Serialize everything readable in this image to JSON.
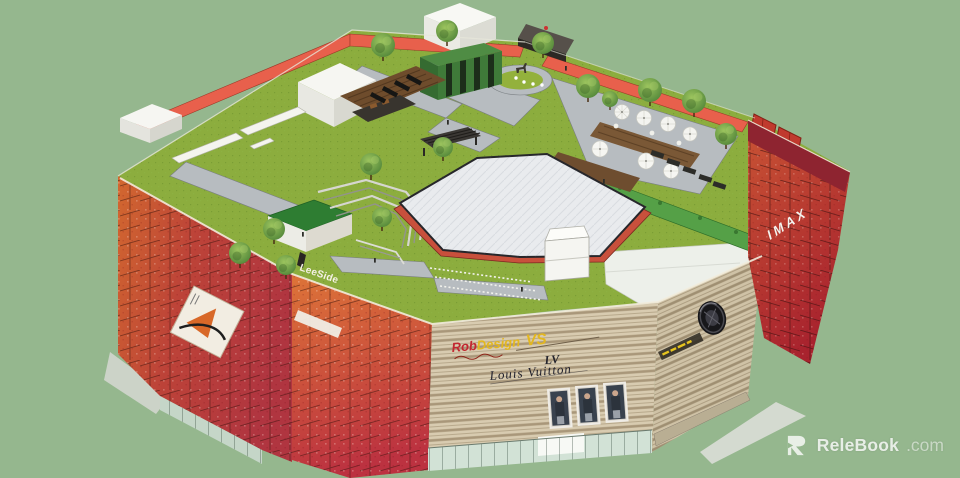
{
  "scene": {
    "type": "3d-architectural-render",
    "subject": "shopping mall rooftop garden with ice rink"
  },
  "signs": {
    "left_tower_sign": "LeeSide",
    "right_tower_sign": "IMAX",
    "front_brand": "Rob",
    "front_brand2": "Design",
    "front_brand_mark": "VS",
    "luxury_brand": "Louis Vuitton",
    "luxury_monogram": "LV"
  },
  "watermark": {
    "logo": "R",
    "brand": "ReleBook",
    "suffix": ".com"
  },
  "palette": {
    "background": "#95b78e",
    "lawn": "#8cad3e",
    "path_gray": "#b7bcc0",
    "rink_surface": "#e9ebee",
    "rink_border": "#c8503c",
    "red_wall": "#e8604c",
    "facade_orange": "#d2682f",
    "facade_red": "#b93540",
    "facade_beige": "#d8cbb0",
    "tower_red": "#b52e38",
    "hedge": "#55a047",
    "deck_brown": "#6e4d2f",
    "tree_green": "#5a9344",
    "glass": "#cfe0d4"
  }
}
